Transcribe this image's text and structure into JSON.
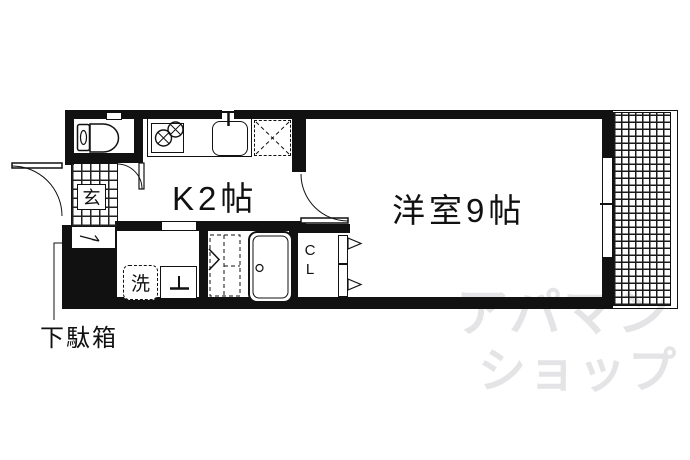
{
  "floor_plan": {
    "labels": {
      "kitchen": "K2帖",
      "main_room": "洋室9帖",
      "entrance": "玄",
      "washer": "洗",
      "closet_top": "C",
      "closet_bottom": "L",
      "shoe_cabinet": "下駄箱"
    },
    "watermark": {
      "line1": "アパマン",
      "line2": "ショップ"
    },
    "colors": {
      "wall": "#111111",
      "watermark": "#e4e4e7",
      "background": "#ffffff"
    }
  }
}
